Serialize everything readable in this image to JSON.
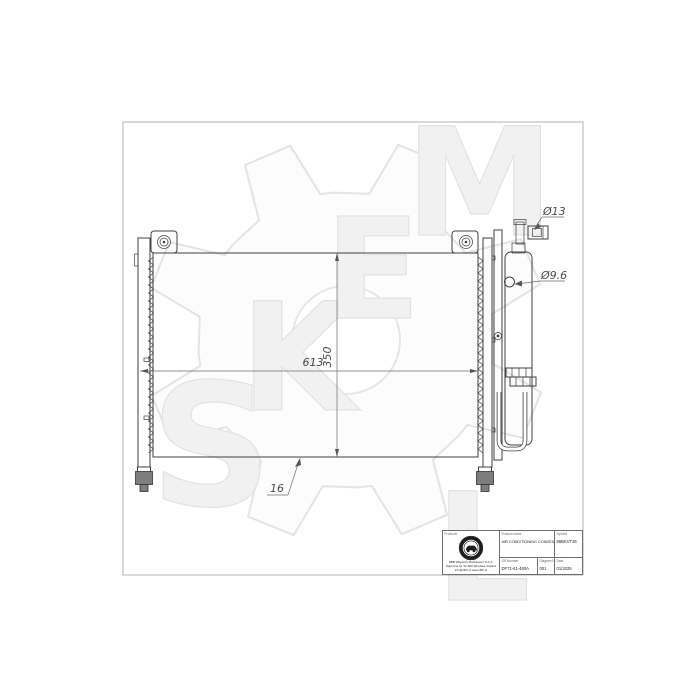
{
  "drawing": {
    "dimensions": {
      "width": "613",
      "height": "350",
      "depth": "16",
      "top_fitting": "Ø13",
      "port": "Ø9.6"
    },
    "watermark": {
      "letters": [
        "S",
        "K",
        "E",
        "M",
        "L"
      ]
    },
    "line_color": "#3f3f3f",
    "watermark_color": "#e8e8e8"
  },
  "title_block": {
    "producer": {
      "label": "Producer",
      "line1": "DBB Wojciech Mackiewicz S.K.A.",
      "line2": "Paprotna St. 51-500 Wrocław, Poland",
      "line3": "info@dbb.pl  www.dbb.pl"
    },
    "product": {
      "label": "Product name",
      "value": "AIR CONDITIONING CONDENSER"
    },
    "symbol": {
      "label": "Symbol",
      "value": "86BKVT36"
    },
    "oe": {
      "label": "OE Number",
      "value": "DF71-61-480A"
    },
    "diagram": {
      "label": "Diagram No.",
      "value": "001"
    },
    "date": {
      "label": "Date",
      "value": "01/2025"
    }
  }
}
